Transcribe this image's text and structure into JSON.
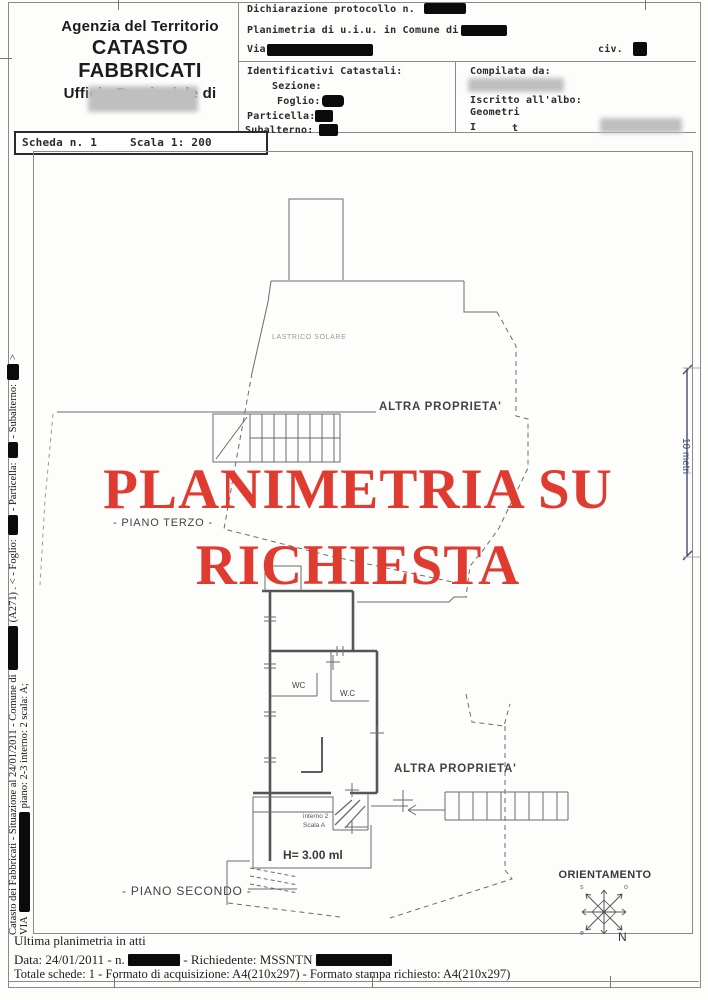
{
  "header": {
    "agency_line1": "Agenzia del Territorio",
    "agency_line2": "CATASTO FABBRICATI",
    "agency_line3": "Ufficio Provinciale di",
    "scheda": "Scheda n. 1",
    "scala": "Scala 1: 200"
  },
  "form": {
    "dichiarazione": "Dichiarazione protocollo n.",
    "planimetria": "Planimetria di u.i.u. in Comune di",
    "via": "Via",
    "civ": "civ.",
    "identificativi_title": "Identificativi Catastali:",
    "sezione": "Sezione:",
    "foglio": "Foglio:",
    "particella": "Particella:",
    "subalterno": "Subalterno:",
    "compilata": "Compilata da:",
    "iscritto": "Iscritto all'albo:",
    "geometri": "Geometri",
    "i_label": "I",
    "t_label": "t"
  },
  "watermark": {
    "line1": "PLANIMETRIA SU",
    "line2": "RICHIESTA",
    "color": "#df3b31"
  },
  "plan": {
    "lastrico": "LASTRICO SOLARE",
    "altra_upper": "ALTRA PROPRIETA'",
    "altra_lower": "ALTRA PROPRIETA'",
    "piano_terzo": "- PIANO TERZO -",
    "piano_secondo": "- PIANO SECONDO -",
    "wc1": "WC",
    "wc2": "W.C",
    "interno": "interno 2",
    "scala_a": "Scala A",
    "height_label": "H= 3.00 ml",
    "orientamento": "ORIENTAMENTO",
    "north": "N",
    "compass_s": "s",
    "compass_o": "o",
    "compass_e": "e",
    "scalebar_label": "10 metri",
    "scalebar_color": "#3f4b70"
  },
  "sidebar": {
    "line1_part1": "Catasto dei Fabbricati - Situazione al 24/01/2011 - Comune di",
    "line1_part2": "(A271) . <  - Foglio:",
    "line1_part3": "- Particella:",
    "line1_part4": "- Subalterno:",
    "line1_end": ">",
    "line2_part1": "VIA",
    "line2_part2": "piano: 2-3 interno: 2 scala: A;"
  },
  "footer": {
    "line1": "Ultima planimetria in atti",
    "line2_a": "Data: 24/01/2011 - n.",
    "line2_b": "- Richiedente: MSSNTN",
    "line3": "Totale schede: 1 - Formato di acquisizione: A4(210x297) - Formato stampa richiesto: A4(210x297)"
  }
}
